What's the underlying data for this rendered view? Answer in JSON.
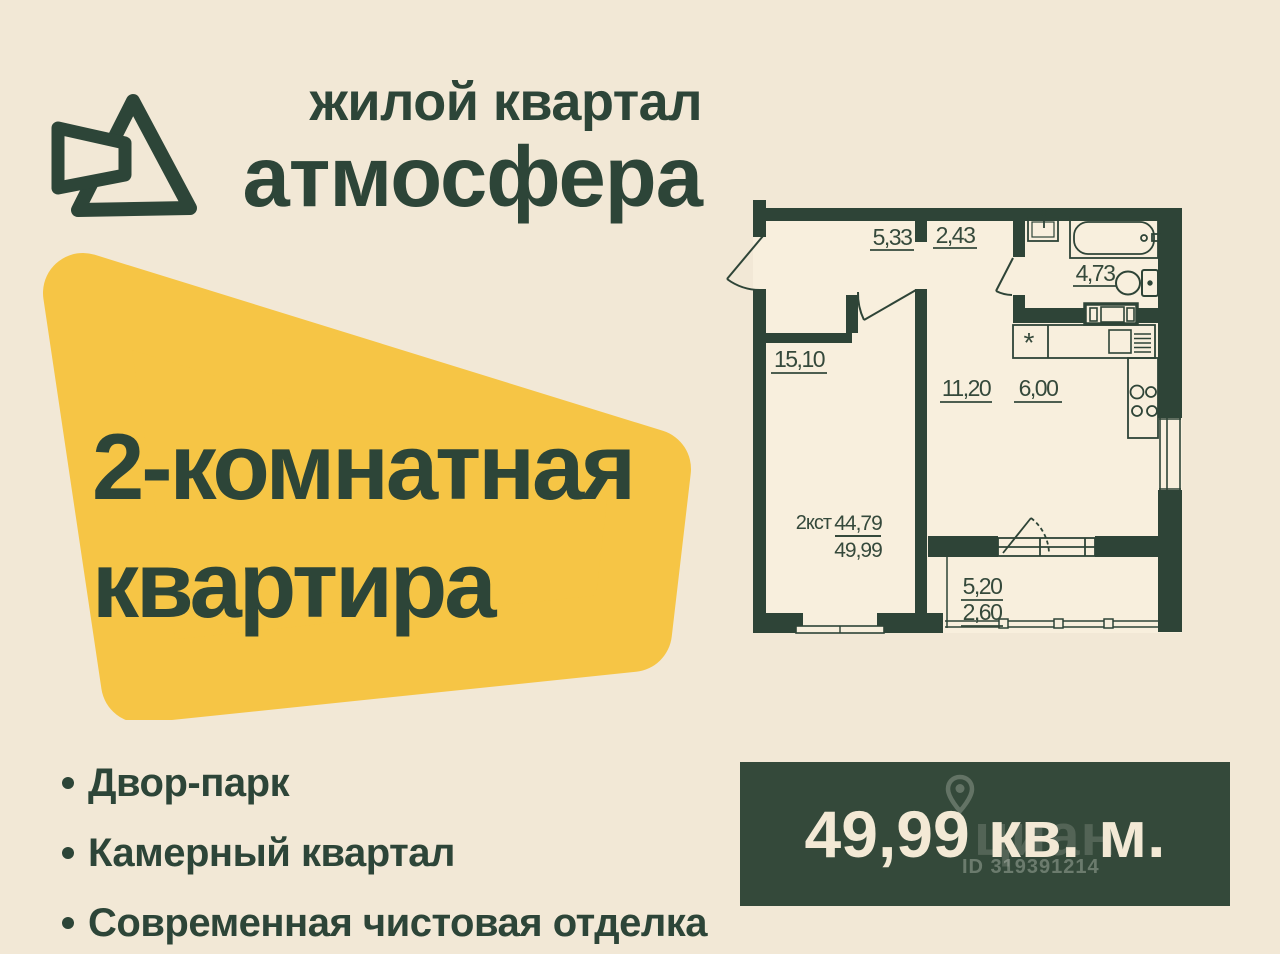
{
  "colors": {
    "background": "#f2e8d6",
    "ink_green": "#2d4538",
    "accent_yellow": "#f6c545",
    "box_green": "#34493a",
    "box_text": "#f3e9d5"
  },
  "header": {
    "brand_top": "жилой квартал",
    "brand_name": "атмосфера"
  },
  "badge": {
    "line1": "2-комнатная",
    "line2": "квартира"
  },
  "plan": {
    "hall_1": "5,33",
    "hall_2": "2,43",
    "bathroom": "4,73",
    "bedroom": "15,10",
    "living": "11,20",
    "kitchen": "6,00",
    "balcony_area": "5,20",
    "balcony_reduced": "2,60",
    "apartment_type": "2кст",
    "living_area": "44,79",
    "total_area": "49,99",
    "fridge_mark": "*"
  },
  "features": {
    "items": [
      "Двор-парк",
      "Камерный квартал",
      "Современная чистовая отделка"
    ]
  },
  "area_box": {
    "area": "49,99",
    "unit": "кв. м.",
    "display": "49,99 кв. м.",
    "watermark_name": "циан",
    "watermark_id": "ID 319391214"
  }
}
